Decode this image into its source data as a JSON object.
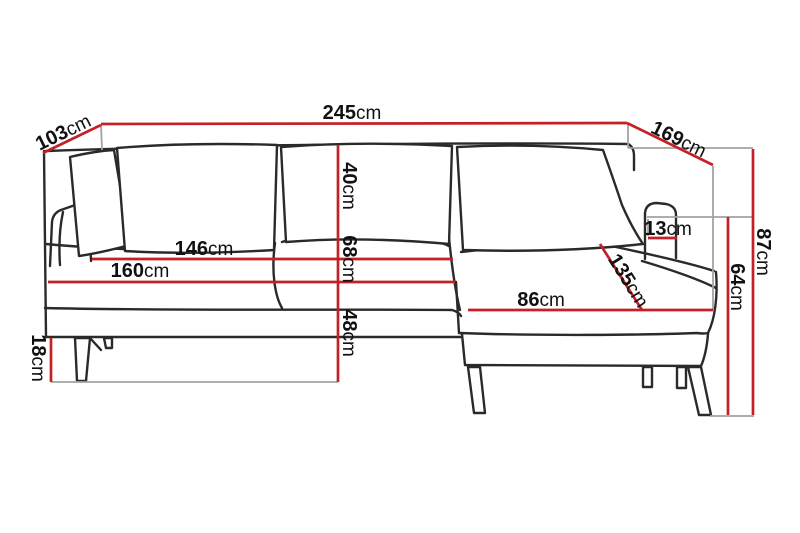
{
  "diagram": {
    "type": "sofa-chaise-dimension-diagram",
    "unit": "cm",
    "background": "#ffffff",
    "colors": {
      "dimension_line": "#c42127",
      "reference_line": "#a3a3a3",
      "outline": "#2a2a2a",
      "label_text": "#111111"
    },
    "measurements": {
      "total_width": {
        "value": "245",
        "unit": "cm"
      },
      "back_depth_left": {
        "value": "103",
        "unit": "cm"
      },
      "chaise_depth_right": {
        "value": "169",
        "unit": "cm"
      },
      "total_height": {
        "value": "87",
        "unit": "cm"
      },
      "arm_side_height": {
        "value": "64",
        "unit": "cm"
      },
      "backrest_height": {
        "value": "40",
        "unit": "cm"
      },
      "back_to_seat_height": {
        "value": "68",
        "unit": "cm"
      },
      "seat_front_height": {
        "value": "48",
        "unit": "cm"
      },
      "cushion_width": {
        "value": "146",
        "unit": "cm"
      },
      "seat_width": {
        "value": "160",
        "unit": "cm"
      },
      "chaise_width": {
        "value": "86",
        "unit": "cm"
      },
      "chaise_length": {
        "value": "135",
        "unit": "cm"
      },
      "armrest_width": {
        "value": "13",
        "unit": "cm"
      },
      "leg_height": {
        "value": "18",
        "unit": "cm"
      }
    }
  }
}
